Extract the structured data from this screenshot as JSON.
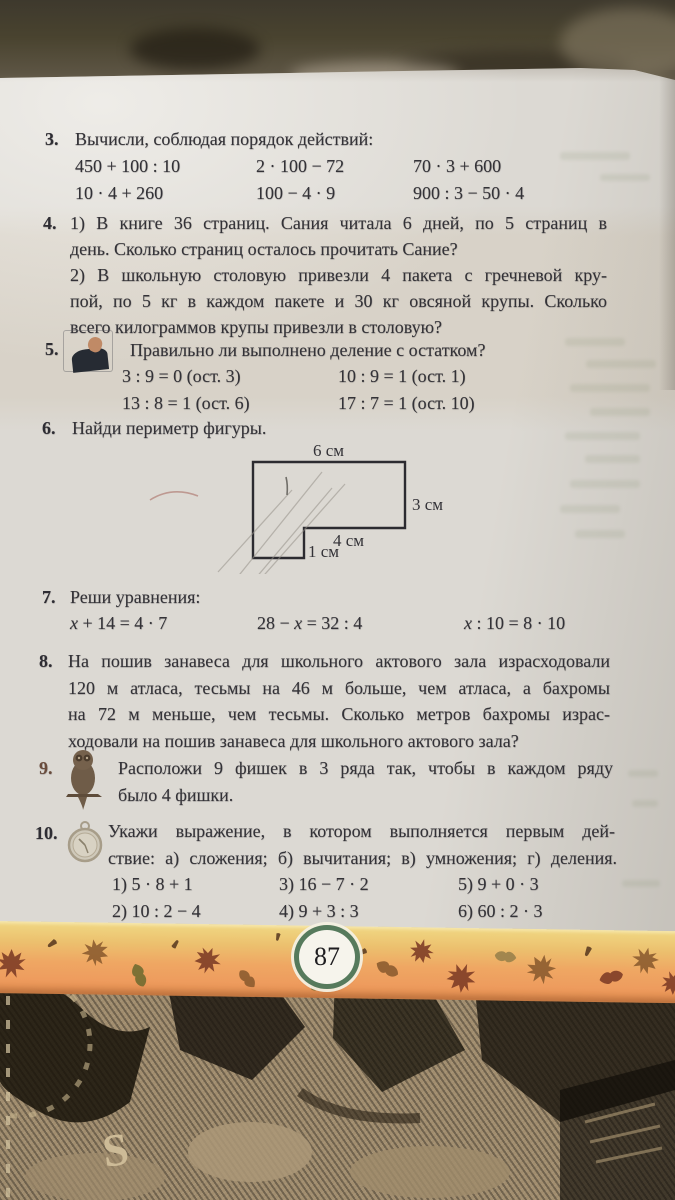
{
  "page_number": "87",
  "colors": {
    "band_top": "#f0d883",
    "band_orange": "#ee9c5e",
    "ring_green": "#567a5c",
    "paper": "#dcd9d3"
  },
  "icons": {
    "p5": "photo-illustration",
    "p9": "owl-icon",
    "p10": "pocket-watch-icon"
  },
  "fabric_letter": "S",
  "p3": {
    "num": "3.",
    "title": "Вычисли, соблюдая порядок действий:",
    "rows": [
      [
        "450 + 100 : 10",
        "2 · 100 − 72",
        "70 · 3 + 600"
      ],
      [
        "10 · 4 + 260",
        "100 − 4 · 9",
        "900 : 3 − 50 · 4"
      ]
    ]
  },
  "p4": {
    "num": "4.",
    "lines": [
      "1) В книге 36 страниц. Сания читала 6 дней, по 5 страниц в",
      "день. Сколько страниц осталось прочитать Сание?",
      "2) В школьную столовую привезли 4 пакета с гречневой кру-",
      "пой, по 5 кг в каждом пакете и 30 кг овсяной крупы. Сколько",
      "всего килограммов крупы привезли в столовую?"
    ]
  },
  "p5": {
    "num": "5.",
    "title": "Правильно ли выполнено деление с  остатком?",
    "rows": [
      [
        "3 : 9 = 0 (ост. 3)",
        "10 : 9 = 1 (ост. 1)"
      ],
      [
        "13 : 8 = 1 (ост. 6)",
        "17 : 7 = 1 (ост. 10)"
      ]
    ]
  },
  "p6": {
    "num": "6.",
    "title": "Найди периметр фигуры.",
    "labels": {
      "top": "6 см",
      "right": "3 см",
      "middle": "4 см",
      "notch": "1 см"
    }
  },
  "p7": {
    "num": "7.",
    "title": "Реши уравнения:",
    "eq1": {
      "a": "x",
      "b": " + 14 = 4 · 7"
    },
    "eq2": {
      "a": "28 − ",
      "b": "x",
      "c": " = 32 : 4"
    },
    "eq3": {
      "a": "x",
      "b": " : 10 = 8 · 10"
    }
  },
  "p8": {
    "num": "8.",
    "lines": [
      "На пошив занавеса для школьного актового зала израсходовали",
      "120 м атласа, тесьмы на 46 м больше, чем атласа, а бахромы",
      "на 72 м меньше, чем тесьмы. Сколько метров бахромы израс-",
      "ходовали на пошив занавеса для школьного актового зала?"
    ]
  },
  "p9": {
    "num": "9.",
    "lines": [
      "Расположи 9 фишек в 3 ряда так, чтобы в каждом ряду",
      "было 4 фишки."
    ]
  },
  "p10": {
    "num": "10.",
    "lines": [
      "Укажи выражение, в котором выполняется первым дей-",
      "ствие: а) сложения; б) вычитания; в) умножения; г) деления."
    ],
    "rows": [
      [
        "1) 5 · 8 + 1",
        "3) 16 − 7 · 2",
        "5) 9 + 0 · 3"
      ],
      [
        "2) 10 : 2 − 4",
        "4) 9 + 3 : 3",
        "6) 60 : 2 · 3"
      ]
    ]
  }
}
